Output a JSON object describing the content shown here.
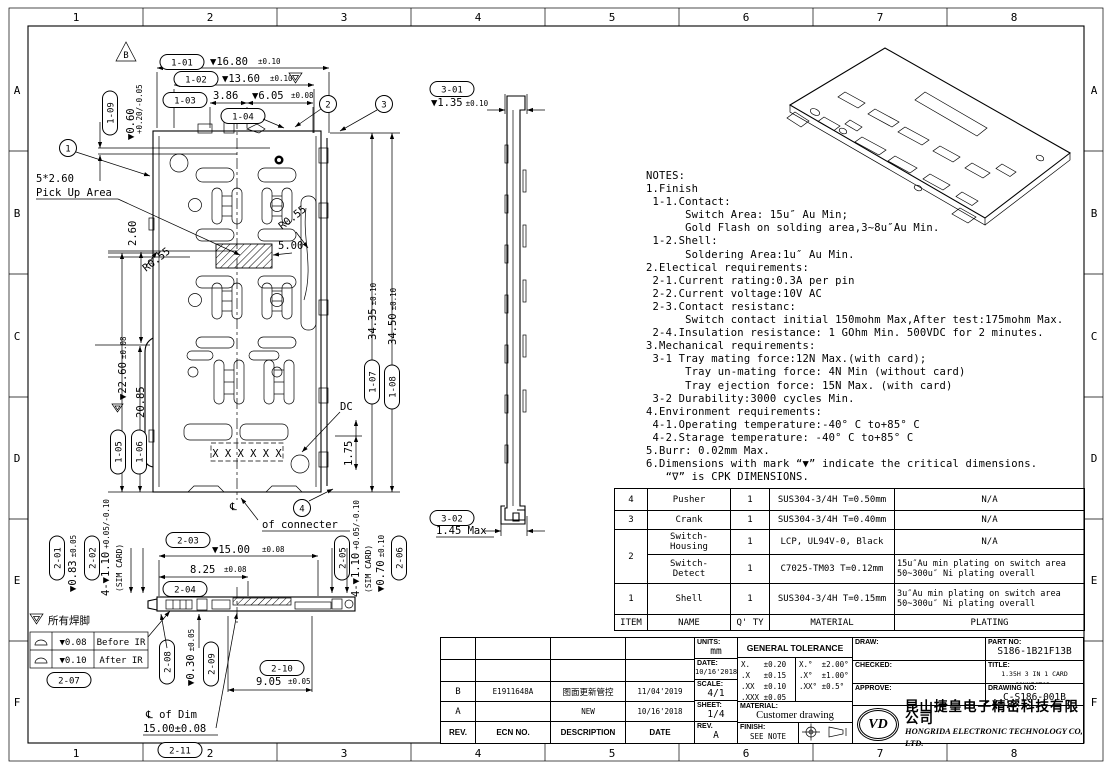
{
  "grid": {
    "cols": [
      "1",
      "2",
      "3",
      "4",
      "5",
      "6",
      "7",
      "8"
    ],
    "rows": [
      "A",
      "B",
      "C",
      "D",
      "E",
      "F"
    ]
  },
  "balloons": {
    "b1": "1",
    "b2": "2",
    "b3": "3",
    "b4": "4",
    "rev_flag": "B"
  },
  "labels": {
    "pickup_line1": "5*2.60",
    "pickup_line2": "Pick Up Area",
    "r055": "R0.55",
    "dim_260": "2.60",
    "dim_500": "5.00",
    "dc": "DC",
    "dim_175": "1.75",
    "x_marks": "X X X X X X",
    "centerline": "℄",
    "of_connecter": "of connecter"
  },
  "dims": {
    "d101": {
      "tag": "1-01",
      "val": "▼16.80",
      "tol": "±0.10"
    },
    "d102": {
      "tag": "1-02",
      "val": "▼13.60",
      "tol": "±0.10"
    },
    "d103": {
      "tag": "1-03",
      "val": "3.86",
      "tol": ""
    },
    "d104": {
      "tag": "1-04",
      "val": "▼6.05",
      "tol": "±0.08"
    },
    "d105": {
      "tag": "1-05",
      "val": "▼22.60",
      "tol": "±0.08"
    },
    "d106": {
      "tag": "1-06",
      "val": "20.85",
      "tol": ""
    },
    "d107": {
      "tag": "1-07",
      "val": "34.35",
      "tol": "±0.10"
    },
    "d108": {
      "tag": "1-08",
      "val": "34.50",
      "tol": "±0.10"
    },
    "d109": {
      "tag": "1-09",
      "val": "▼0.60",
      "tol": "+0.20/-0.05"
    },
    "d201": {
      "tag": "2-01",
      "val": "▼0.83",
      "tol": "±0.05"
    },
    "d202": {
      "tag": "2-02",
      "val": "4-▼1.10",
      "tol": "+0.05/-0.10",
      "extra": "(SIM CARD)"
    },
    "d203": {
      "tag": "2-03",
      "val": "▼15.00",
      "tol": "±0.08"
    },
    "d204": {
      "tag": "2-04",
      "val": "8.25",
      "tol": "±0.08"
    },
    "d205": {
      "tag": "2-05",
      "val": "4-▼1.10",
      "tol": "+0.05/-0.10",
      "extra": "(SIM CARD)"
    },
    "d206": {
      "tag": "2-06",
      "val": "▼0.70",
      "tol": "±0.10"
    },
    "d207": {
      "tag": "2-07",
      "val": "",
      "tol": ""
    },
    "d208": {
      "tag": "2-08",
      "val": "",
      "tol": ""
    },
    "d209": {
      "tag": "2-09",
      "val": "▼0.30",
      "tol": "±0.05"
    },
    "d210": {
      "tag": "2-10",
      "val": "9.05",
      "tol": "±0.05"
    },
    "d211": {
      "tag": "2-11",
      "val": "℄ of Dim",
      "tol": "15.00±0.08"
    },
    "d301": {
      "tag": "3-01",
      "val": "▼1.35",
      "tol": "±0.10"
    },
    "d302": {
      "tag": "3-02",
      "val": "1.45 Max",
      "tol": ""
    }
  },
  "flatness": {
    "note": "所有焊脚",
    "rows": [
      {
        "val": "▼0.08",
        "when": "Before IR"
      },
      {
        "val": "▼0.10",
        "when": "After  IR"
      }
    ]
  },
  "notes": {
    "lines": [
      "NOTES:",
      "1.Finish",
      " 1-1.Contact:",
      "      Switch Area: 15u″ Au Min;",
      "      Gold Flash on solding area,3~8u″Au Min.",
      " 1-2.Shell:",
      "      Soldering Area:1u″ Au Min.",
      "2.Electical requirements:",
      " 2-1.Current rating:0.3A per pin",
      " 2-2.Current voltage:10V AC",
      " 2-3.Contact resistanc:",
      "      Switch contact initial 150mohm Max,After test:175mohm Max.",
      " 2-4.Insulation resistance: 1 GOhm Min. 500VDC for 2 minutes.",
      "3.Mechanical requirements:",
      " 3-1 Tray mating force:12N Max.(with card);",
      "      Tray un-mating force: 4N Min (without card)",
      "      Tray ejection force: 15N Max. (with card)",
      " 3-2 Durability:3000 cycles Min.",
      "4.Environment requirements:",
      " 4-1.Operating temperature:-40° C to+85° C",
      " 4-2.Starage temperature: -40° C to+85° C",
      "5.Burr: 0.02mm Max.",
      "6.Dimensions with mark “▼” indicate the critical dimensions.",
      "   “∇” is CPK DIMENSIONS."
    ]
  },
  "bom": {
    "headers": {
      "item": "ITEM",
      "name": "NAME",
      "qty": "Q' TY",
      "material": "MATERIAL",
      "plating": "PLATING"
    },
    "rows": [
      {
        "item": "4",
        "name": "Pusher",
        "qty": "1",
        "material": "SUS304-3/4H T=0.50mm",
        "plating": "N/A"
      },
      {
        "item": "3",
        "name": "Crank",
        "qty": "1",
        "material": "SUS304-3/4H T=0.40mm",
        "plating": "N/A"
      },
      {
        "item": "2",
        "name": "Switch-\nHousing",
        "qty": "1",
        "material": "LCP, UL94V-0, Black",
        "plating": "N/A"
      },
      {
        "item": "",
        "name": "Switch-\nDetect",
        "qty": "1",
        "material": "C7025-TM03 T=0.12mm",
        "plating": "15u″Au min plating on switch area\n50~300u″ Ni plating overall"
      },
      {
        "item": "1",
        "name": "Shell",
        "qty": "1",
        "material": "SUS304-3/4H T=0.15mm",
        "plating": "3u″Au min plating on switch area\n50~300u″ Ni plating overall"
      }
    ]
  },
  "titleblock": {
    "rev_table": {
      "headers": {
        "rev": "REV.",
        "ecn": "ECN NO.",
        "desc": "DESCRIPTION",
        "date": "DATE"
      },
      "rows": [
        {
          "rev": "B",
          "ecn": "E1911648A",
          "desc": "图面更新管控",
          "date": "11/04'2019"
        },
        {
          "rev": "A",
          "ecn": "",
          "desc": "NEW",
          "date": "10/16'2018"
        }
      ]
    },
    "units_label": "UNITS:",
    "units_value": "mm",
    "date_label": "DATE:",
    "date_value": "10/16'2018",
    "scale_label": "SCALE:",
    "scale_value": "4/1",
    "sheet_label": "SHEET:",
    "sheet_value": "1/4",
    "rev_label": "REV.",
    "rev_value": "A",
    "tolerance_title": "GENERAL TOLERANCE",
    "tolerance_left": [
      "X.   ±0.20",
      ".X   ±0.15",
      ".XX  ±0.10",
      ".XXX ±0.05"
    ],
    "tolerance_right": [
      "X.°  ±2.00°",
      ".X°  ±1.00°",
      ".XX° ±0.5°",
      ""
    ],
    "material_label": "MATERIAL:",
    "material_value": "Customer drawing",
    "finish_label": "FINISH:",
    "finish_value": "SEE NOTE",
    "draw_label": "DRAW:",
    "checked_label": "CHECKED:",
    "approve_label": "APPROVE:",
    "part_no_label": "PART NO:",
    "part_no_value": "S186-1B21F13B",
    "title_label": "TITLE:",
    "title_value": "1.35H 3 IN 1 CARD CONNECTOR.",
    "drawing_no_label": "DRAWING NO:",
    "drawing_no_value": "C-S186-001B",
    "logo_monogram": "VD",
    "company_cn": "昆山捷皇电子精密科技有限公司",
    "company_en": "HONGRIDA ELECTRONIC TECHNOLOGY CO, LTD."
  }
}
